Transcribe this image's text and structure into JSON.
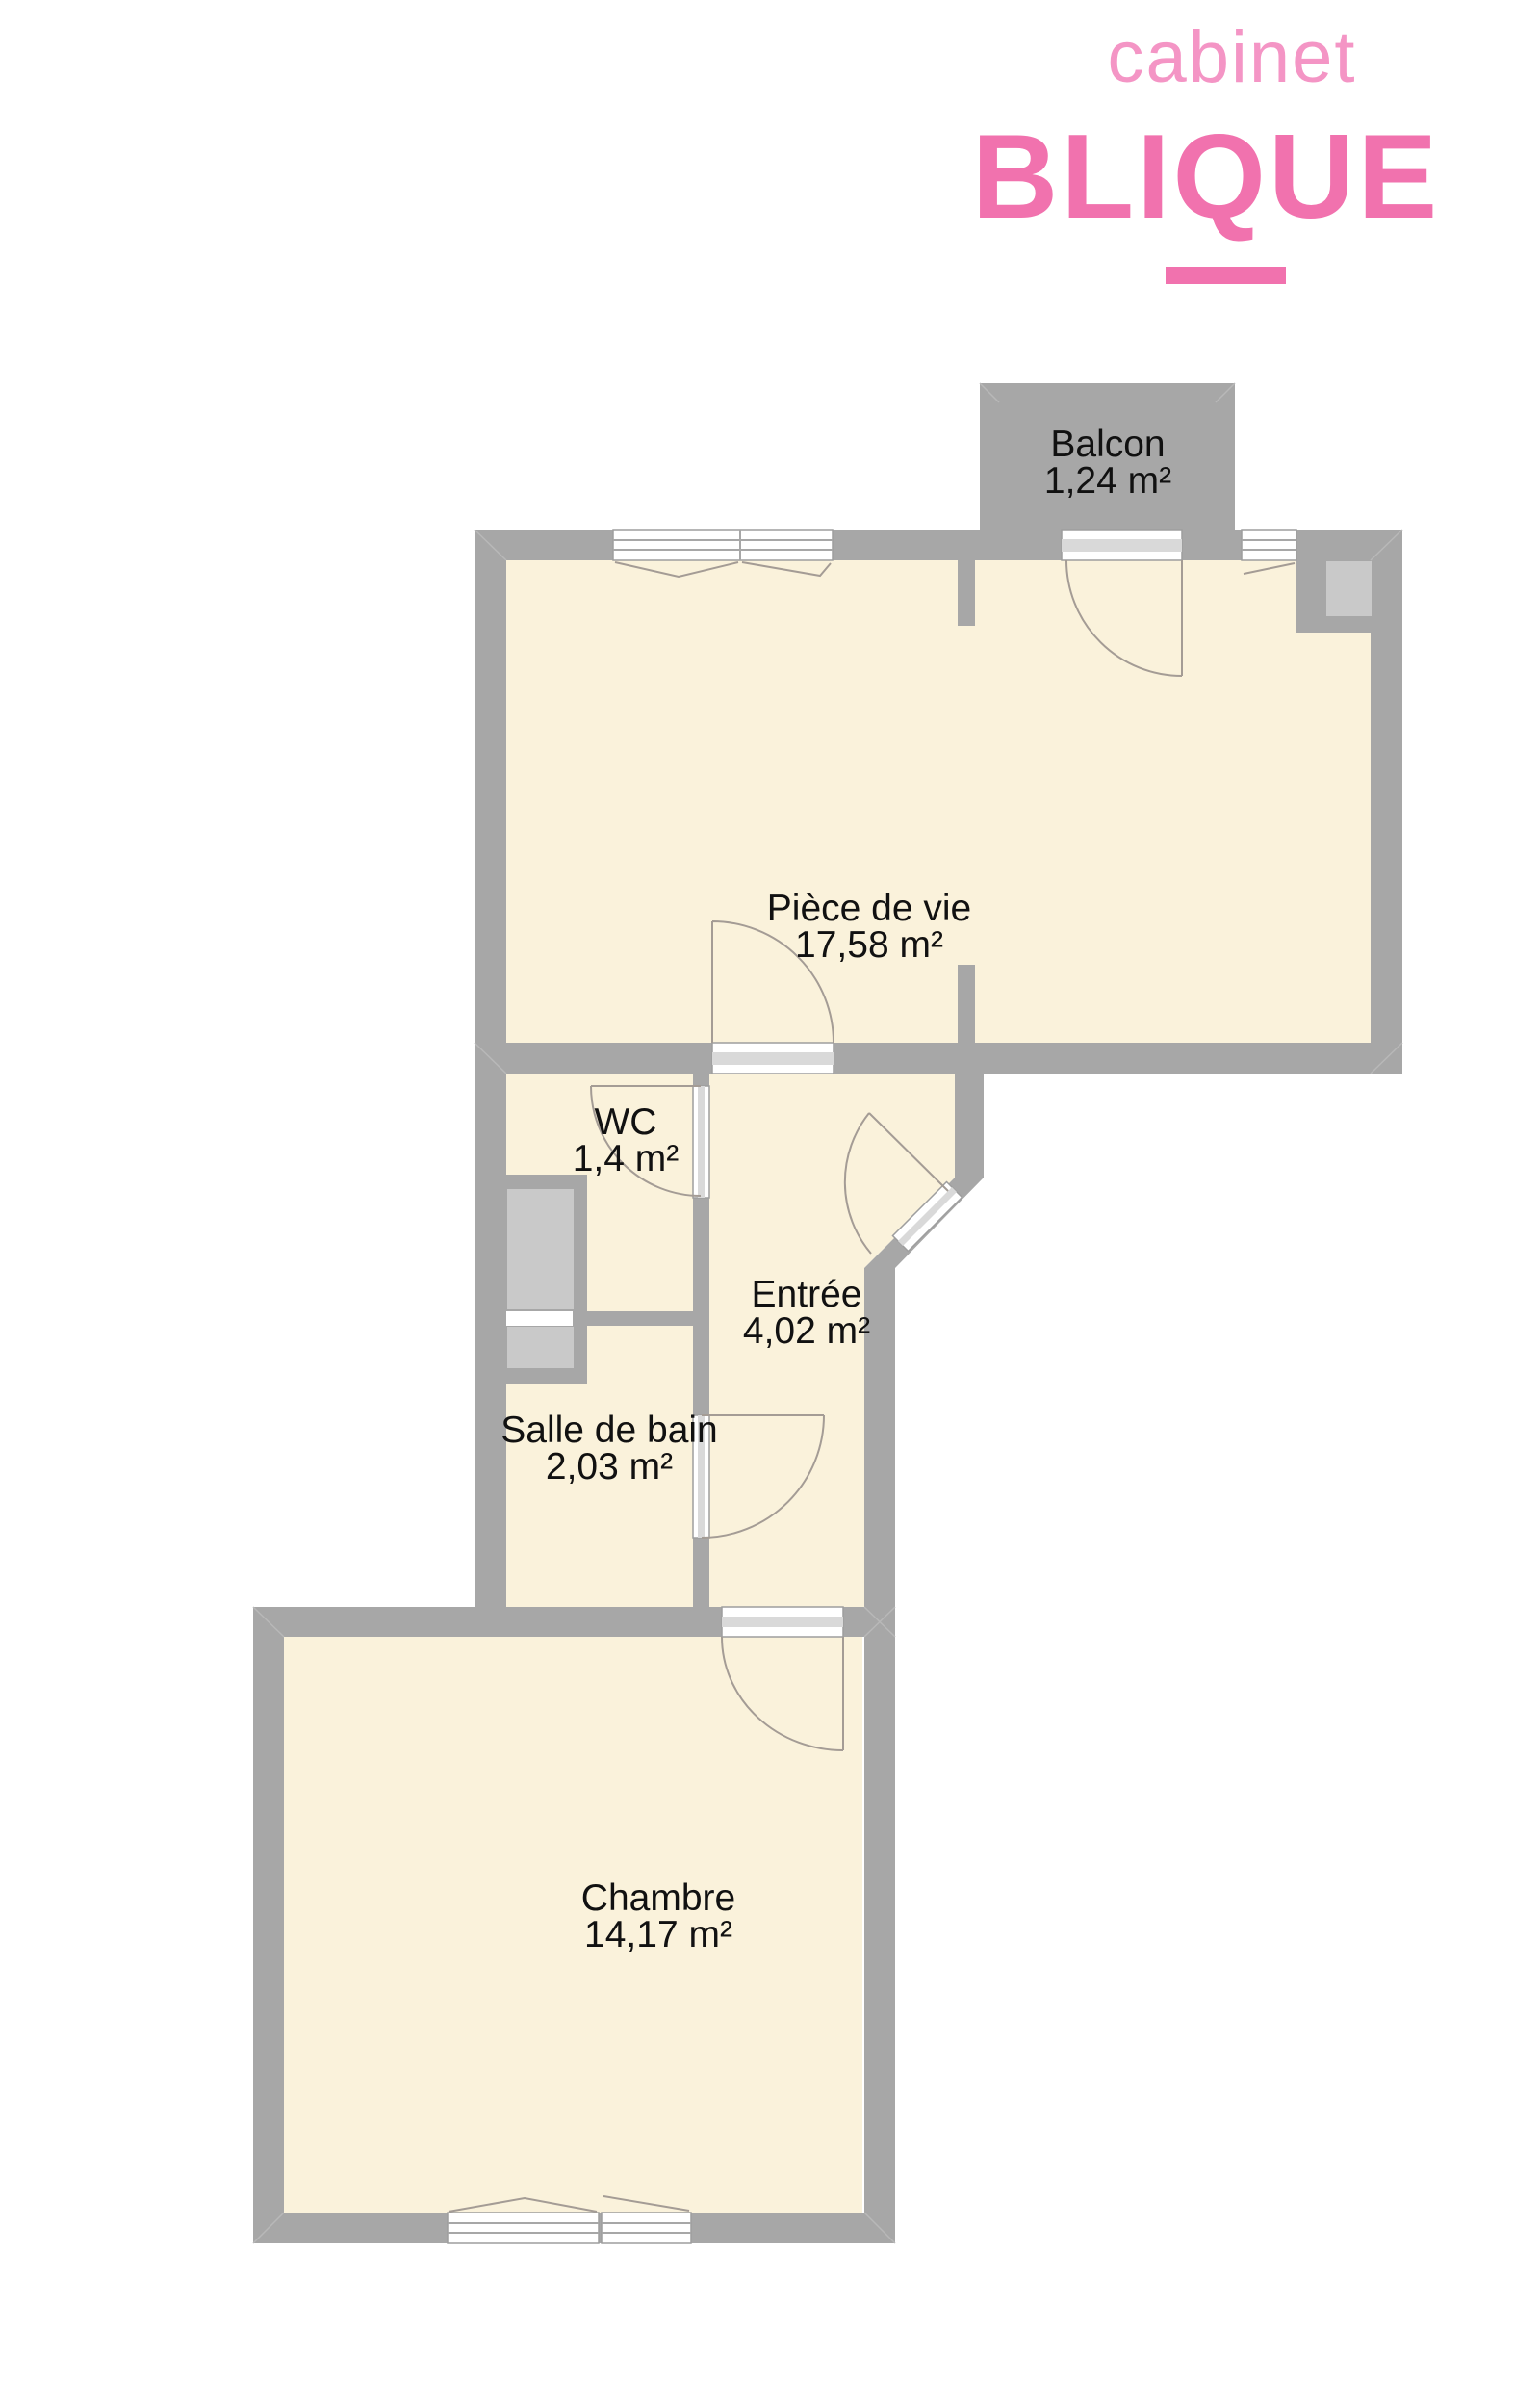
{
  "logo": {
    "brand_line1": "cabinet",
    "brand_line2": "BLIQUE"
  },
  "colors": {
    "brand_pink": "#F172AE",
    "brand_pink_light": "#F495C5",
    "balcony_green": "#3CE85A",
    "wall_gray": "#A7A7A7",
    "floor_cream": "#FAF2DB"
  },
  "rooms": [
    {
      "id": "balcon",
      "name": "Balcon",
      "area": "1,24 m²"
    },
    {
      "id": "piece-de-vie",
      "name": "Pièce de vie",
      "area": "17,58 m²"
    },
    {
      "id": "wc",
      "name": "WC",
      "area": "1,4 m²"
    },
    {
      "id": "entree",
      "name": "Entrée",
      "area": "4,02 m²"
    },
    {
      "id": "salle-de-bain",
      "name": "Salle de bain",
      "area": "2,03 m²"
    },
    {
      "id": "chambre",
      "name": "Chambre",
      "area": "14,17 m²"
    }
  ]
}
